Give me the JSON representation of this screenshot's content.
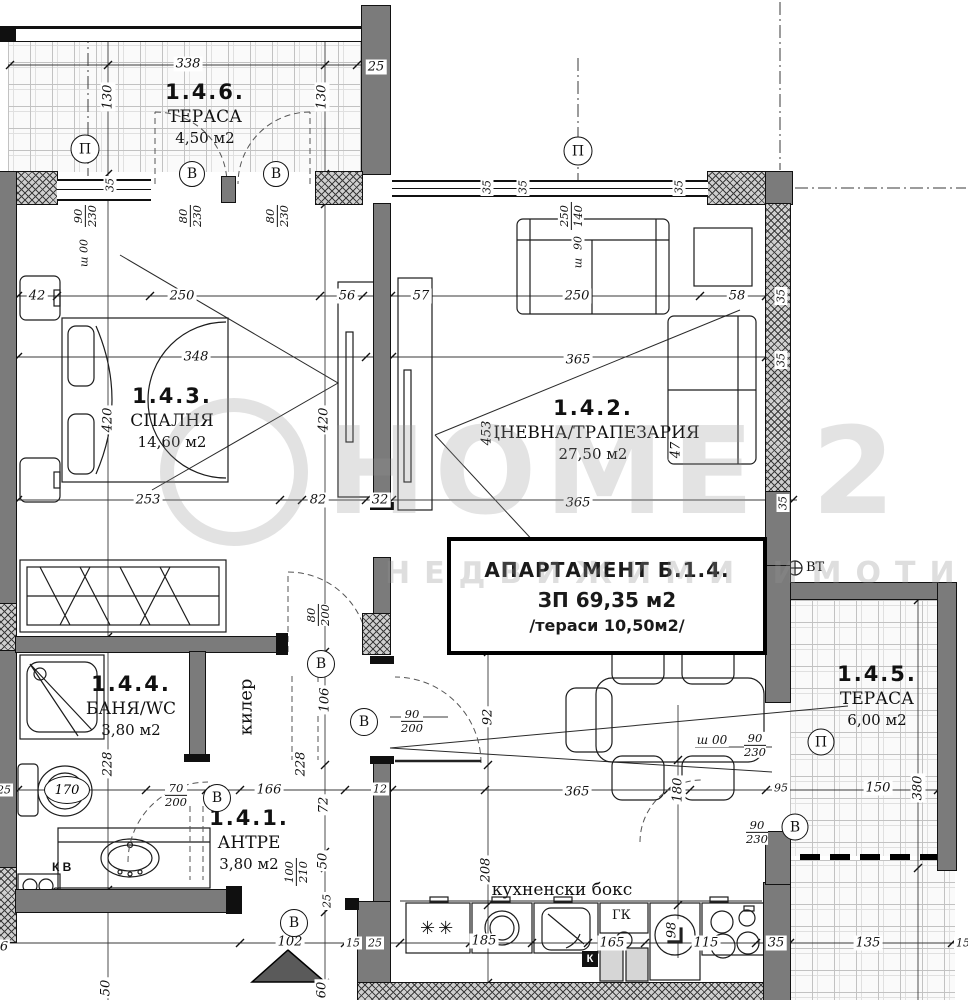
{
  "title_block": {
    "line1": "АПАРТАМЕНТ Б.1.4.",
    "line2": "ЗП 69,35 м2",
    "line3": "/тераси 10,50м2/"
  },
  "rooms": {
    "terrace_top": {
      "number": "1.4.6.",
      "name": "ТЕРАСА",
      "area": "4,50 м2"
    },
    "bedroom": {
      "number": "1.4.3.",
      "name": "СПАЛНЯ",
      "area": "14,60 м2"
    },
    "living": {
      "number": "1.4.2.",
      "name": "ДНЕВНА/ТРАПЕЗАРИЯ",
      "area": "27,50 м2"
    },
    "bath": {
      "number": "1.4.4.",
      "name": "БАНЯ/WC",
      "area": "3,80 м2"
    },
    "entry": {
      "number": "1.4.1.",
      "name": "АНТРЕ",
      "area": "3,80 м2"
    },
    "terrace_right": {
      "number": "1.4.5.",
      "name": "ТЕРАСА",
      "area": "6,00 м2"
    },
    "closet": {
      "name": "килер"
    },
    "kitchen": {
      "name": "кухненски бокс"
    }
  },
  "annotations": {
    "vt": "ВТ",
    "kv": "К В",
    "gk": "ГК",
    "k": "К",
    "toilet_mark": "170",
    "freezer_symbol": "✳✳"
  },
  "watermark": {
    "brand": "HOME 2",
    "subtitle": "НЕДВИЖИМИ ИМОТИ"
  },
  "markers": [
    {
      "t": "П",
      "x": 85,
      "y": 149,
      "d": 27
    },
    {
      "t": "В",
      "x": 192,
      "y": 174,
      "d": 24
    },
    {
      "t": "В",
      "x": 276,
      "y": 174,
      "d": 24
    },
    {
      "t": "П",
      "x": 578,
      "y": 151,
      "d": 27
    },
    {
      "t": "В",
      "x": 321,
      "y": 664,
      "d": 26
    },
    {
      "t": "В",
      "x": 364,
      "y": 722,
      "d": 26
    },
    {
      "t": "В",
      "x": 217,
      "y": 798,
      "d": 26
    },
    {
      "t": "В",
      "x": 294,
      "y": 923,
      "d": 26
    },
    {
      "t": "П",
      "x": 821,
      "y": 742,
      "d": 25
    },
    {
      "t": "В",
      "x": 795,
      "y": 827,
      "d": 25
    }
  ],
  "dim_labels": [
    {
      "t": "338",
      "x": 188,
      "y": 64
    },
    {
      "t": "130",
      "x": 108,
      "y": 97,
      "r": 1
    },
    {
      "t": "130",
      "x": 322,
      "y": 97,
      "r": 1
    },
    {
      "t": "25",
      "x": 376,
      "y": 67
    },
    {
      "t": "35",
      "x": 110,
      "y": 185,
      "r": 1,
      "fs": 11
    },
    {
      "t": "35",
      "x": 487,
      "y": 187,
      "r": 1,
      "fs": 11
    },
    {
      "t": "35",
      "x": 523,
      "y": 187,
      "r": 1,
      "fs": 11
    },
    {
      "t": "35",
      "x": 679,
      "y": 187,
      "r": 1,
      "fs": 11
    },
    {
      "t": "ш 00",
      "x": 84,
      "y": 253,
      "r": 1,
      "fs": 11
    },
    {
      "t": "90",
      "x": 578,
      "y": 243,
      "r": 1,
      "fs": 11
    },
    {
      "t": "ш",
      "x": 578,
      "y": 263,
      "r": 1,
      "fs": 11
    },
    {
      "t": "42",
      "x": 37,
      "y": 296
    },
    {
      "t": "250",
      "x": 182,
      "y": 296
    },
    {
      "t": "56",
      "x": 347,
      "y": 296
    },
    {
      "t": "57",
      "x": 421,
      "y": 296
    },
    {
      "t": "250",
      "x": 577,
      "y": 296
    },
    {
      "t": "58",
      "x": 737,
      "y": 296
    },
    {
      "t": "35",
      "x": 781,
      "y": 296,
      "r": 1,
      "fs": 11
    },
    {
      "t": "348",
      "x": 196,
      "y": 357
    },
    {
      "t": "365",
      "x": 578,
      "y": 360
    },
    {
      "t": "35",
      "x": 781,
      "y": 360,
      "r": 1,
      "fs": 11
    },
    {
      "t": "420",
      "x": 108,
      "y": 420,
      "r": 1
    },
    {
      "t": "420",
      "x": 324,
      "y": 420,
      "r": 1
    },
    {
      "t": "453",
      "x": 487,
      "y": 433,
      "r": 1
    },
    {
      "t": "47",
      "x": 676,
      "y": 450,
      "r": 1
    },
    {
      "t": "253",
      "x": 148,
      "y": 500
    },
    {
      "t": "82",
      "x": 318,
      "y": 500
    },
    {
      "t": "32",
      "x": 380,
      "y": 500
    },
    {
      "t": "365",
      "x": 578,
      "y": 503
    },
    {
      "t": "35",
      "x": 783,
      "y": 503,
      "r": 1,
      "fs": 11
    },
    {
      "t": "106",
      "x": 325,
      "y": 700,
      "r": 1
    },
    {
      "t": "92",
      "x": 488,
      "y": 717,
      "r": 1
    },
    {
      "t": "12",
      "x": 380,
      "y": 789,
      "fs": 11
    },
    {
      "t": "208",
      "x": 486,
      "y": 870,
      "r": 1
    },
    {
      "t": "228",
      "x": 108,
      "y": 764,
      "r": 1
    },
    {
      "t": "228",
      "x": 301,
      "y": 764,
      "r": 1
    },
    {
      "t": "166",
      "x": 269,
      "y": 790
    },
    {
      "t": "72",
      "x": 324,
      "y": 805,
      "r": 1
    },
    {
      "t": "50",
      "x": 323,
      "y": 861,
      "r": 1
    },
    {
      "t": "25",
      "x": 327,
      "y": 901,
      "r": 1,
      "fs": 11
    },
    {
      "t": "25",
      "x": 4,
      "y": 790,
      "fs": 11
    },
    {
      "t": "6",
      "x": 4,
      "y": 947
    },
    {
      "t": "102",
      "x": 290,
      "y": 942
    },
    {
      "t": "15",
      "x": 353,
      "y": 943,
      "fs": 11
    },
    {
      "t": "25",
      "x": 375,
      "y": 943,
      "fs": 11
    },
    {
      "t": "50",
      "x": 106,
      "y": 988,
      "r": 1
    },
    {
      "t": "60",
      "x": 322,
      "y": 990,
      "r": 1
    },
    {
      "t": "185",
      "x": 484,
      "y": 941
    },
    {
      "t": "165",
      "x": 612,
      "y": 943
    },
    {
      "t": "115",
      "x": 706,
      "y": 943
    },
    {
      "t": "35",
      "x": 776,
      "y": 943
    },
    {
      "t": "135",
      "x": 868,
      "y": 943
    },
    {
      "t": "15",
      "x": 963,
      "y": 943,
      "fs": 11
    },
    {
      "t": "98",
      "x": 672,
      "y": 930,
      "r": 1
    },
    {
      "t": "ш 00",
      "x": 712,
      "y": 740,
      "fs": 12
    },
    {
      "t": "365",
      "x": 577,
      "y": 792
    },
    {
      "t": "180",
      "x": 678,
      "y": 790,
      "r": 1
    },
    {
      "t": "95",
      "x": 781,
      "y": 788,
      "fs": 11
    },
    {
      "t": "150",
      "x": 878,
      "y": 788
    },
    {
      "t": "380",
      "x": 918,
      "y": 788,
      "r": 1
    }
  ],
  "frac_labels": [
    {
      "n": "90",
      "d": "230",
      "x": 85,
      "y": 216,
      "r": 1
    },
    {
      "n": "80",
      "d": "230",
      "x": 190,
      "y": 216,
      "r": 1
    },
    {
      "n": "80",
      "d": "230",
      "x": 277,
      "y": 216,
      "r": 1
    },
    {
      "n": "250",
      "d": "140",
      "x": 571,
      "y": 216,
      "r": 1
    },
    {
      "n": "80",
      "d": "200",
      "x": 318,
      "y": 615,
      "r": 1
    },
    {
      "n": "90",
      "d": "200",
      "x": 412,
      "y": 721
    },
    {
      "n": "70",
      "d": "200",
      "x": 176,
      "y": 795
    },
    {
      "n": "100",
      "d": "210",
      "x": 296,
      "y": 872,
      "r": 1
    },
    {
      "n": "90",
      "d": "230",
      "x": 755,
      "y": 745
    },
    {
      "n": "90",
      "d": "230",
      "x": 757,
      "y": 832
    }
  ]
}
